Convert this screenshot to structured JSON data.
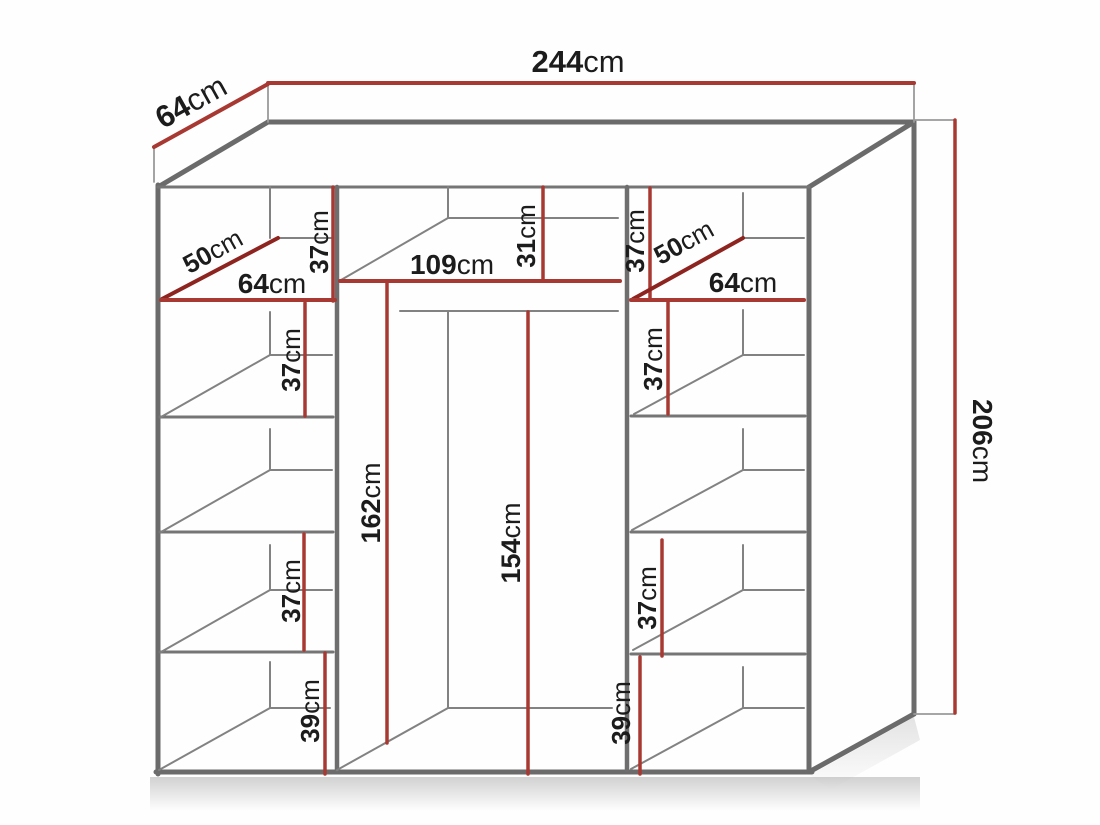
{
  "diagram": {
    "kind": "wardrobe-dimension-diagram",
    "unit": "cm",
    "colors": {
      "dimension_red": "#a83832",
      "dimension_dark_red": "#8e241f",
      "structure_gray": "#6b6b6b",
      "label_color": "#1c1c1c",
      "background": "#fefefe"
    },
    "labels": {
      "width": {
        "value": "244",
        "unit": "cm"
      },
      "depth": {
        "value": "64",
        "unit": "cm"
      },
      "height": {
        "value": "206",
        "unit": "cm"
      },
      "left": {
        "top_gap": {
          "value": "37",
          "unit": "cm"
        },
        "shelf_depth": {
          "value": "50",
          "unit": "cm"
        },
        "shelf_width": {
          "value": "64",
          "unit": "cm"
        },
        "gap2": {
          "value": "37",
          "unit": "cm"
        },
        "gap3": {
          "value": "37",
          "unit": "cm"
        },
        "bottom_gap": {
          "value": "39",
          "unit": "cm"
        }
      },
      "middle": {
        "shelf_width": {
          "value": "109",
          "unit": "cm"
        },
        "top_gap": {
          "value": "31",
          "unit": "cm"
        },
        "left_height": {
          "value": "162",
          "unit": "cm"
        },
        "rail_height": {
          "value": "154",
          "unit": "cm"
        }
      },
      "right": {
        "top_gap": {
          "value": "37",
          "unit": "cm"
        },
        "shelf_depth": {
          "value": "50",
          "unit": "cm"
        },
        "shelf_width": {
          "value": "64",
          "unit": "cm"
        },
        "gap2": {
          "value": "37",
          "unit": "cm"
        },
        "gap3": {
          "value": "37",
          "unit": "cm"
        },
        "bottom_gap": {
          "value": "39",
          "unit": "cm"
        }
      }
    }
  }
}
